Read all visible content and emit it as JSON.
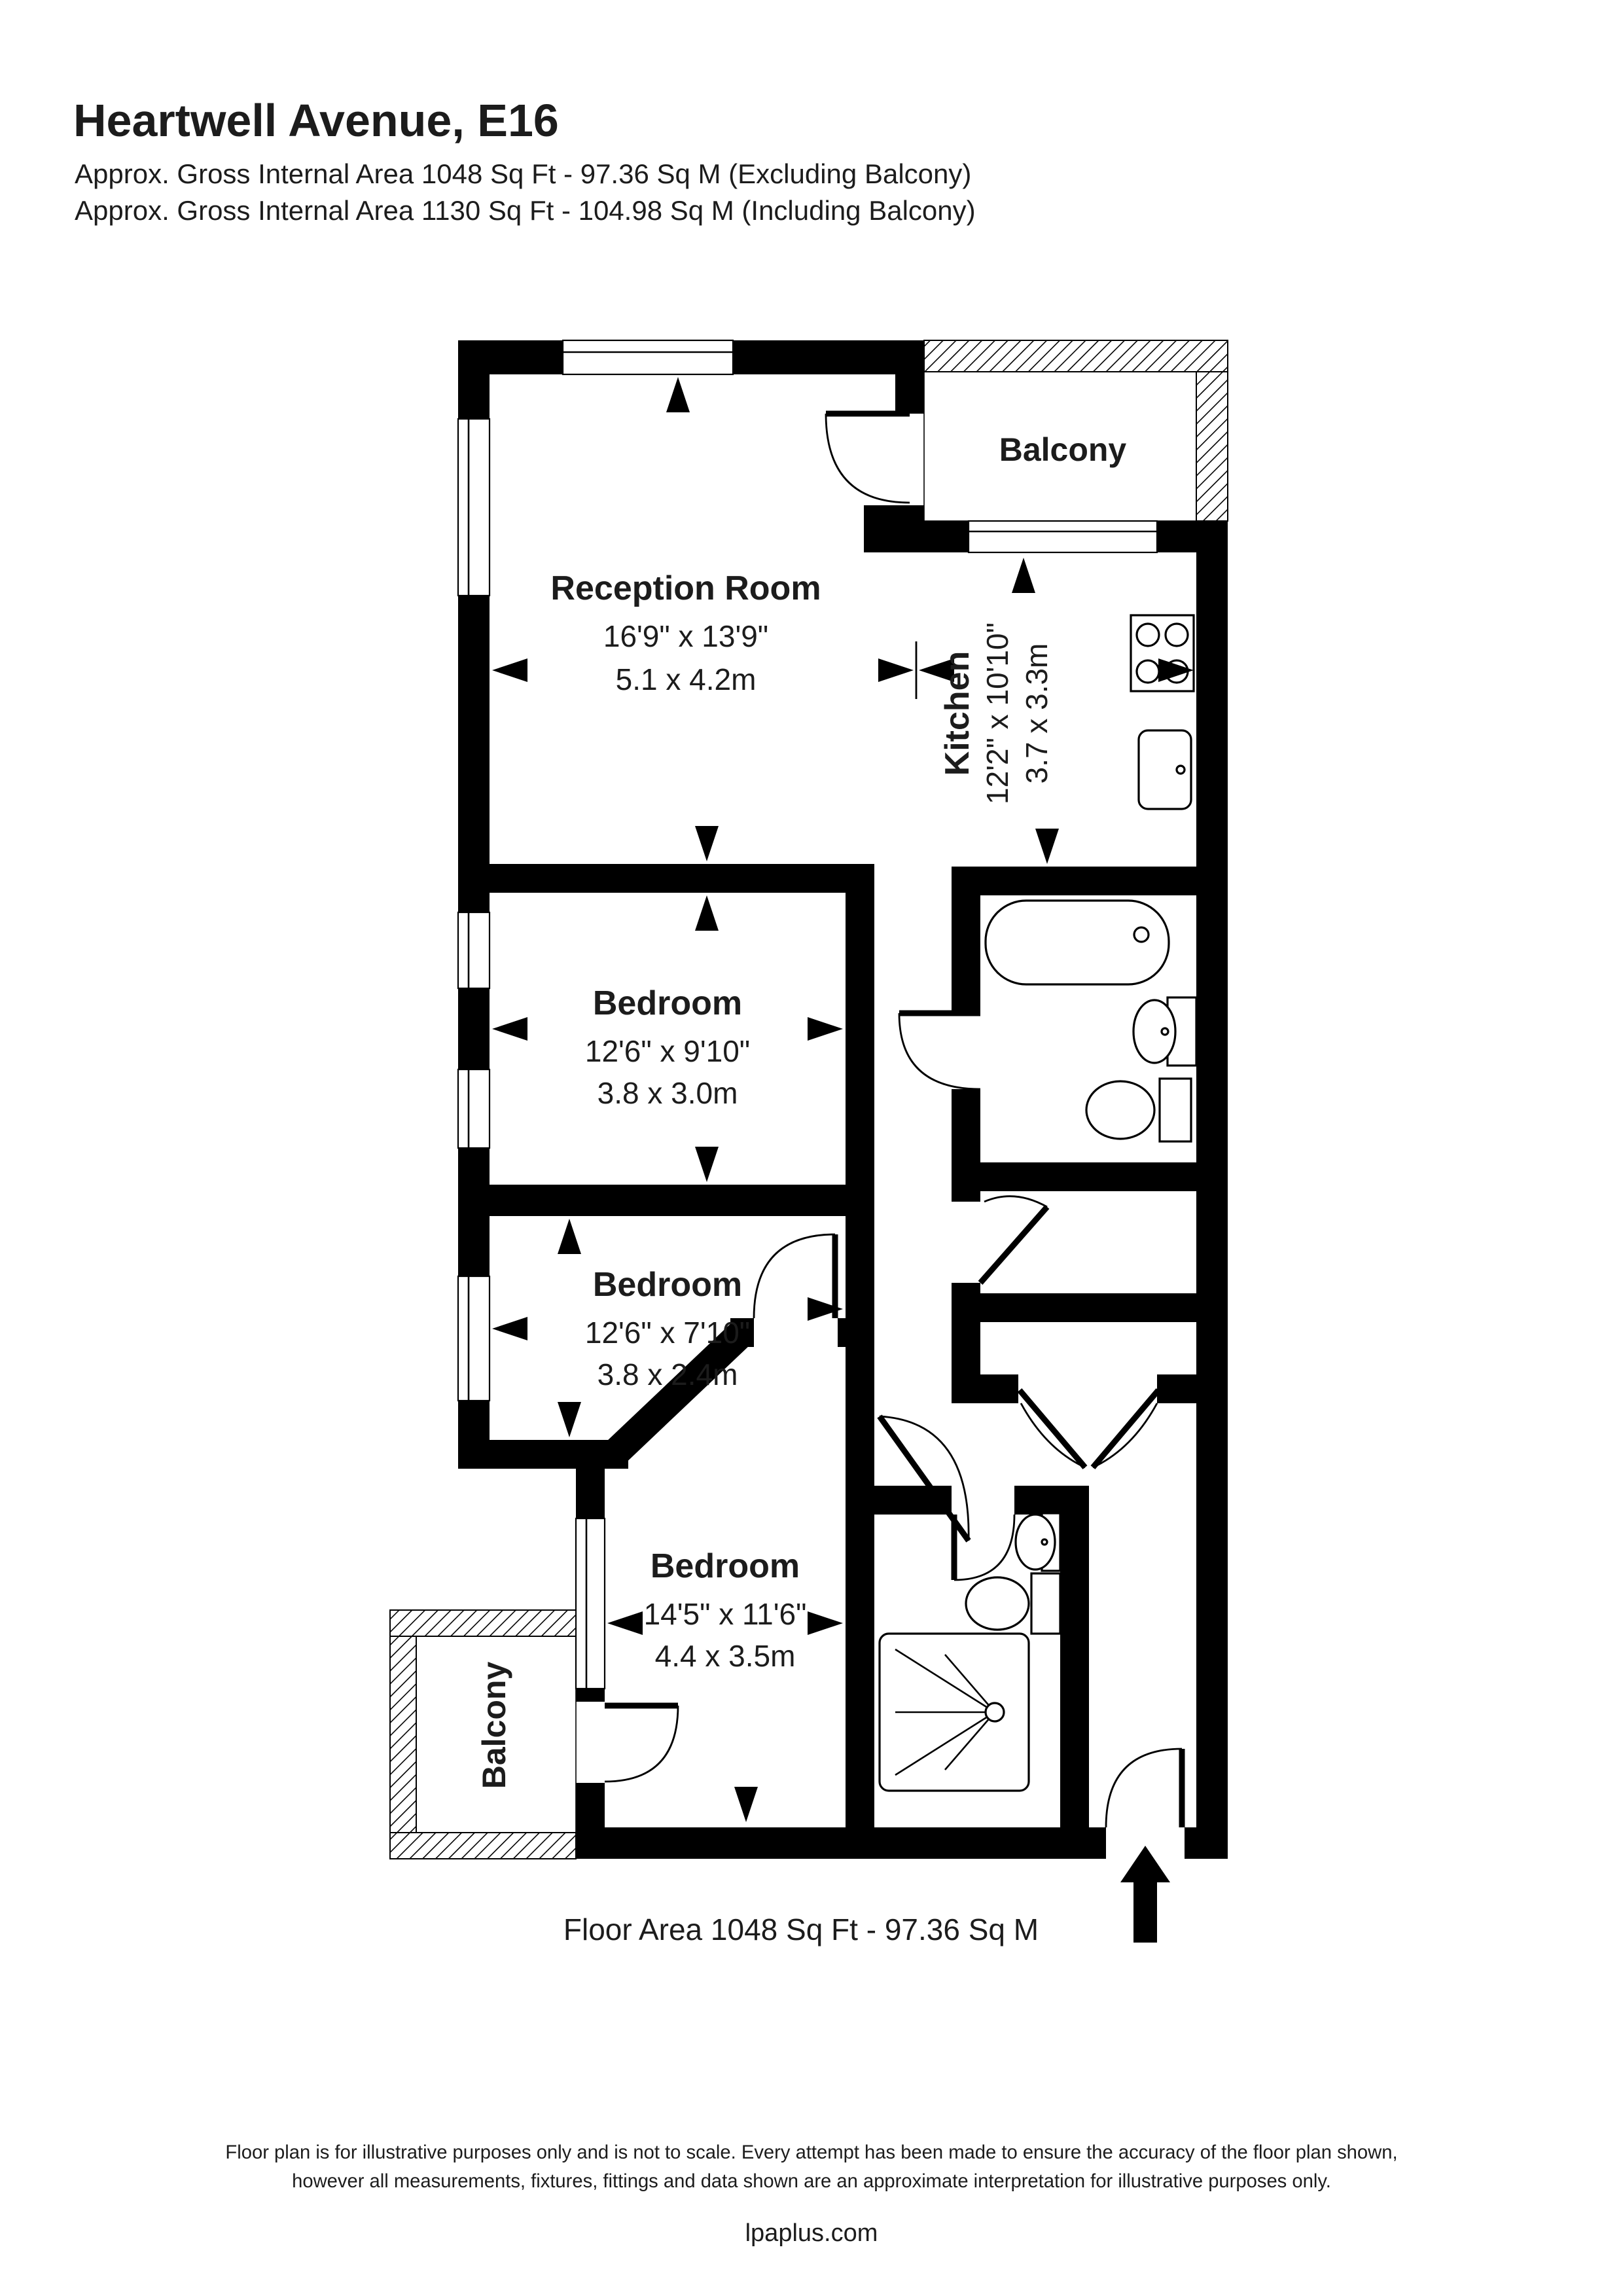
{
  "header": {
    "title": "Heartwell Avenue, E16",
    "area_excluding": "Approx. Gross Internal Area 1048 Sq Ft - 97.36 Sq M (Excluding Balcony)",
    "area_including": "Approx. Gross Internal Area 1130 Sq Ft - 104.98 Sq M (Including Balcony)"
  },
  "rooms": {
    "reception": {
      "name": "Reception Room",
      "imperial": "16'9\" x 13'9\"",
      "metric": "5.1 x 4.2m"
    },
    "kitchen": {
      "name": "Kitchen",
      "imperial": "12'2\" x 10'10\"",
      "metric": "3.7 x 3.3m"
    },
    "bedroom1": {
      "name": "Bedroom",
      "imperial": "12'6\" x 9'10\"",
      "metric": "3.8 x 3.0m"
    },
    "bedroom2": {
      "name": "Bedroom",
      "imperial": "12'6\" x 7'10\"",
      "metric": "3.8 x 2.4m"
    },
    "bedroom3": {
      "name": "Bedroom",
      "imperial": "14'5\" x 11'6\"",
      "metric": "4.4 x 3.5m"
    },
    "balcony_top": {
      "name": "Balcony"
    },
    "balcony_bottom": {
      "name": "Balcony"
    }
  },
  "plan": {
    "floor_area_caption": "Floor Area 1048 Sq Ft - 97.36 Sq M"
  },
  "footer": {
    "disclaimer_line1": "Floor plan is for illustrative purposes only and is not to scale. Every attempt has been made to ensure the accuracy of the floor plan shown,",
    "disclaimer_line2": "however all measurements, fixtures, fittings and data shown are an approximate interpretation for illustrative purposes only.",
    "website": "lpaplus.com"
  },
  "colors": {
    "wall": "#000000",
    "text": "#1c1c1c",
    "background": "#ffffff"
  }
}
